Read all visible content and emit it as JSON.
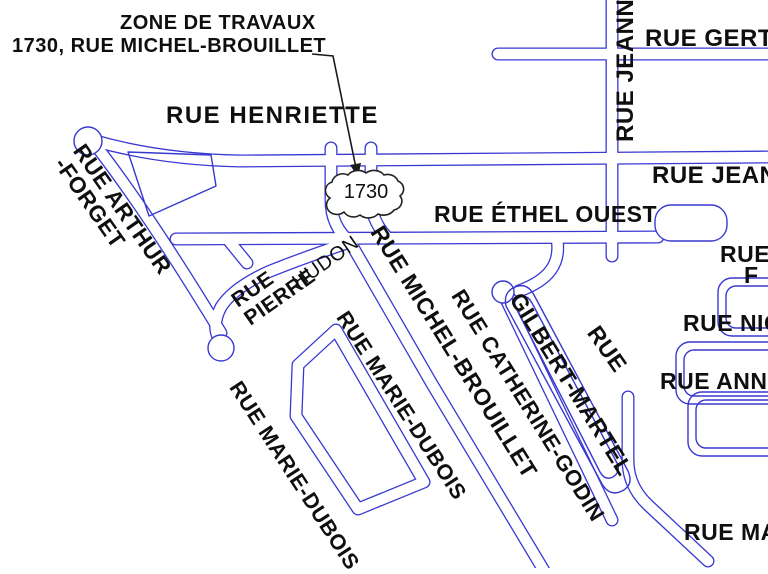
{
  "callout": {
    "line1": "ZONE DE TRAVAUX",
    "line2": "1730, RUE MICHEL-BROUILLET",
    "cloud_text": "1730"
  },
  "streets": {
    "henriette": "RUE HENRIETTE",
    "gertrude": "RUE GERTR",
    "jeanne_vertical": "RUE JEANNE",
    "jeanne_horizontal": "RUE JEANN",
    "ethel_ouest": "RUE ÉTHEL OUEST",
    "arthur_forget_line1": "RUE ARTHUR",
    "arthur_forget_line2": "-FORGET",
    "pierre_line1": "RUE",
    "pierre_line2": "PIERRE",
    "hudon": "HUDON",
    "michel_brouillet": "RUE MICHEL-BROUILLET",
    "marie_dubois_upper": "RUE MARIE-DUBOIS",
    "marie_dubois_lower": "RUE MARIE-DUBOIS",
    "catherine_godin": "RUE CATHERINE-GODIN",
    "gilbert_martel_rue": "RUE",
    "gilbert_martel": "GILBERT-MARTEL",
    "rue_f_line1": "RUE",
    "rue_f_line2": "F",
    "nicole": "RUE NIC",
    "anne": "RUE ANNE",
    "marie_bottom": "RUE MA"
  },
  "colors": {
    "street_blue": "#3838d2",
    "text_black": "#0f0f0f",
    "cloud_outline": "#222222"
  }
}
